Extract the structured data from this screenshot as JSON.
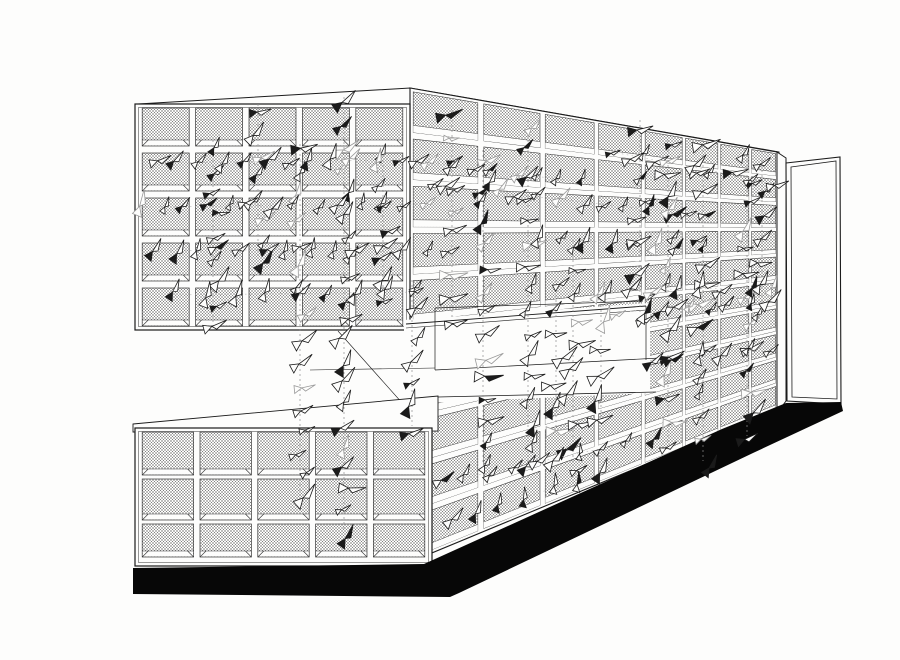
{
  "artwork": {
    "kind": "architectural ink perspective drawing",
    "subject": "folded mesh-panel pavilion with hanging flocks of folded-paper birds on strings"
  },
  "palette": {
    "paper": "#fdfdfc",
    "white": "#fdfdfc",
    "ink": "#1b1b1b",
    "mesh_line": "#7e7e7e",
    "panel_stroke": "#333333",
    "shadow": "#070707",
    "string": "#8f8f8f",
    "chain_line": "#aaaaaa",
    "ghost": "#9a9a9a"
  },
  "canvas": {
    "width": 900,
    "height": 660
  },
  "front_grids": [
    {
      "name": "upper-front-grid",
      "x": 135,
      "y": 104,
      "w": 275,
      "h": 226,
      "cols": 5,
      "rows": [
        [
          4,
          38
        ],
        [
          49,
          38
        ],
        [
          94,
          38
        ],
        [
          139,
          38
        ],
        [
          184,
          38
        ]
      ]
    },
    {
      "name": "lower-front-grid",
      "x": 135,
      "y": 428,
      "w": 297,
      "h": 138,
      "cols": 5,
      "rows": [
        [
          4,
          43
        ],
        [
          51,
          41
        ],
        [
          96,
          33
        ]
      ]
    }
  ],
  "receding_grid": {
    "x0": 410,
    "t0": 88,
    "b0": 562,
    "x1": 777,
    "t1": 152,
    "b1": 410,
    "cols": 8,
    "rows": 10,
    "shrink": 0.87
  },
  "roof": {
    "front": [
      [
        138,
        104
      ],
      [
        410,
        88
      ],
      [
        410,
        104
      ]
    ],
    "side": [
      [
        410,
        88
      ],
      [
        779,
        152
      ],
      [
        779,
        158
      ],
      [
        410,
        98
      ]
    ]
  },
  "opening": {
    "poly": [
      [
        404,
        320
      ],
      [
        650,
        303
      ],
      [
        650,
        393
      ],
      [
        404,
        404
      ]
    ],
    "lines": [
      {
        "pts": [
          [
            406,
            324
          ],
          [
            646,
            306
          ]
        ],
        "w": 0.9
      },
      {
        "pts": [
          [
            406,
            328
          ],
          [
            646,
            310
          ]
        ],
        "w": 0.6
      },
      {
        "pts": [
          [
            435,
            308
          ],
          [
            643,
            301
          ]
        ],
        "w": 0.7
      },
      {
        "pts": [
          [
            435,
            308
          ],
          [
            435,
            370
          ]
        ],
        "w": 0.7
      },
      {
        "pts": [
          [
            435,
            370
          ],
          [
            660,
            358
          ]
        ],
        "w": 0.7
      },
      {
        "pts": [
          [
            646,
            306
          ],
          [
            646,
            360
          ]
        ],
        "w": 0.7
      },
      {
        "pts": [
          [
            338,
            331
          ],
          [
            420,
            423
          ]
        ],
        "w": 0.6
      },
      {
        "pts": [
          [
            310,
            370
          ],
          [
            435,
            368
          ]
        ],
        "w": 0.6
      },
      {
        "pts": [
          [
            438,
            397
          ],
          [
            656,
            392
          ]
        ],
        "w": 0.8
      }
    ]
  },
  "lid": {
    "poly": [
      [
        133,
        424
      ],
      [
        438,
        396
      ],
      [
        438,
        431
      ],
      [
        133,
        432
      ]
    ]
  },
  "end_post": {
    "poly": [
      [
        777,
        152
      ],
      [
        786,
        158
      ],
      [
        786,
        401
      ],
      [
        777,
        413
      ]
    ]
  },
  "door": {
    "outer": [
      [
        786,
        163
      ],
      [
        840,
        157
      ],
      [
        841,
        404
      ],
      [
        787,
        401
      ]
    ],
    "inner": [
      [
        791,
        167
      ],
      [
        836,
        161
      ],
      [
        837,
        399
      ],
      [
        792,
        397
      ]
    ]
  },
  "shadow": {
    "poly": [
      [
        133,
        568
      ],
      [
        424,
        564
      ],
      [
        722,
        429
      ],
      [
        786,
        403
      ],
      [
        841,
        402
      ],
      [
        843,
        411
      ],
      [
        753,
        453
      ],
      [
        459,
        593
      ],
      [
        450,
        597
      ],
      [
        133,
        594
      ]
    ]
  },
  "streams": [
    {
      "x": 213,
      "y1": 148,
      "y2": 330,
      "n": 9
    },
    {
      "x": 258,
      "y1": 112,
      "y2": 262,
      "n": 8
    },
    {
      "x": 300,
      "y1": 152,
      "y2": 500,
      "n": 16
    },
    {
      "x": 344,
      "y1": 105,
      "y2": 535,
      "n": 21
    },
    {
      "x": 383,
      "y1": 158,
      "y2": 305,
      "n": 7
    },
    {
      "x": 412,
      "y1": 288,
      "y2": 430,
      "n": 7
    },
    {
      "x": 452,
      "y1": 118,
      "y2": 322,
      "n": 10
    },
    {
      "x": 483,
      "y1": 158,
      "y2": 468,
      "n": 15
    },
    {
      "x": 528,
      "y1": 128,
      "y2": 470,
      "n": 16
    },
    {
      "x": 556,
      "y1": 288,
      "y2": 432,
      "n": 7
    },
    {
      "x": 573,
      "y1": 248,
      "y2": 470,
      "n": 10
    },
    {
      "x": 601,
      "y1": 298,
      "y2": 424,
      "n": 6
    },
    {
      "x": 640,
      "y1": 128,
      "y2": 318,
      "n": 9
    },
    {
      "x": 668,
      "y1": 148,
      "y2": 448,
      "n": 14
    },
    {
      "x": 703,
      "y1": 148,
      "y2": 465,
      "n": 15
    },
    {
      "x": 747,
      "y1": 158,
      "y2": 440,
      "n": 13
    },
    {
      "x": 762,
      "y1": 168,
      "y2": 312,
      "n": 7
    }
  ],
  "chains": [
    {
      "x1": 155,
      "y1": 163,
      "x2": 420,
      "y2": 160,
      "n": 13
    },
    {
      "x1": 140,
      "y1": 207,
      "x2": 425,
      "y2": 204,
      "n": 14
    },
    {
      "x1": 150,
      "y1": 251,
      "x2": 425,
      "y2": 248,
      "n": 13
    },
    {
      "x1": 175,
      "y1": 295,
      "x2": 418,
      "y2": 292,
      "n": 9
    },
    {
      "x1": 432,
      "y1": 185,
      "x2": 690,
      "y2": 214,
      "n": 13
    },
    {
      "x1": 428,
      "y1": 162,
      "x2": 580,
      "y2": 182,
      "n": 8
    },
    {
      "x1": 540,
      "y1": 238,
      "x2": 700,
      "y2": 248,
      "n": 8
    },
    {
      "x1": 612,
      "y1": 152,
      "x2": 772,
      "y2": 182,
      "n": 9
    },
    {
      "x1": 605,
      "y1": 290,
      "x2": 772,
      "y2": 288,
      "n": 8
    },
    {
      "x1": 620,
      "y1": 312,
      "x2": 772,
      "y2": 302,
      "n": 8
    },
    {
      "x1": 650,
      "y1": 362,
      "x2": 768,
      "y2": 348,
      "n": 6
    },
    {
      "x1": 440,
      "y1": 483,
      "x2": 650,
      "y2": 438,
      "n": 10
    },
    {
      "x1": 448,
      "y1": 521,
      "x2": 602,
      "y2": 473,
      "n": 7
    }
  ]
}
